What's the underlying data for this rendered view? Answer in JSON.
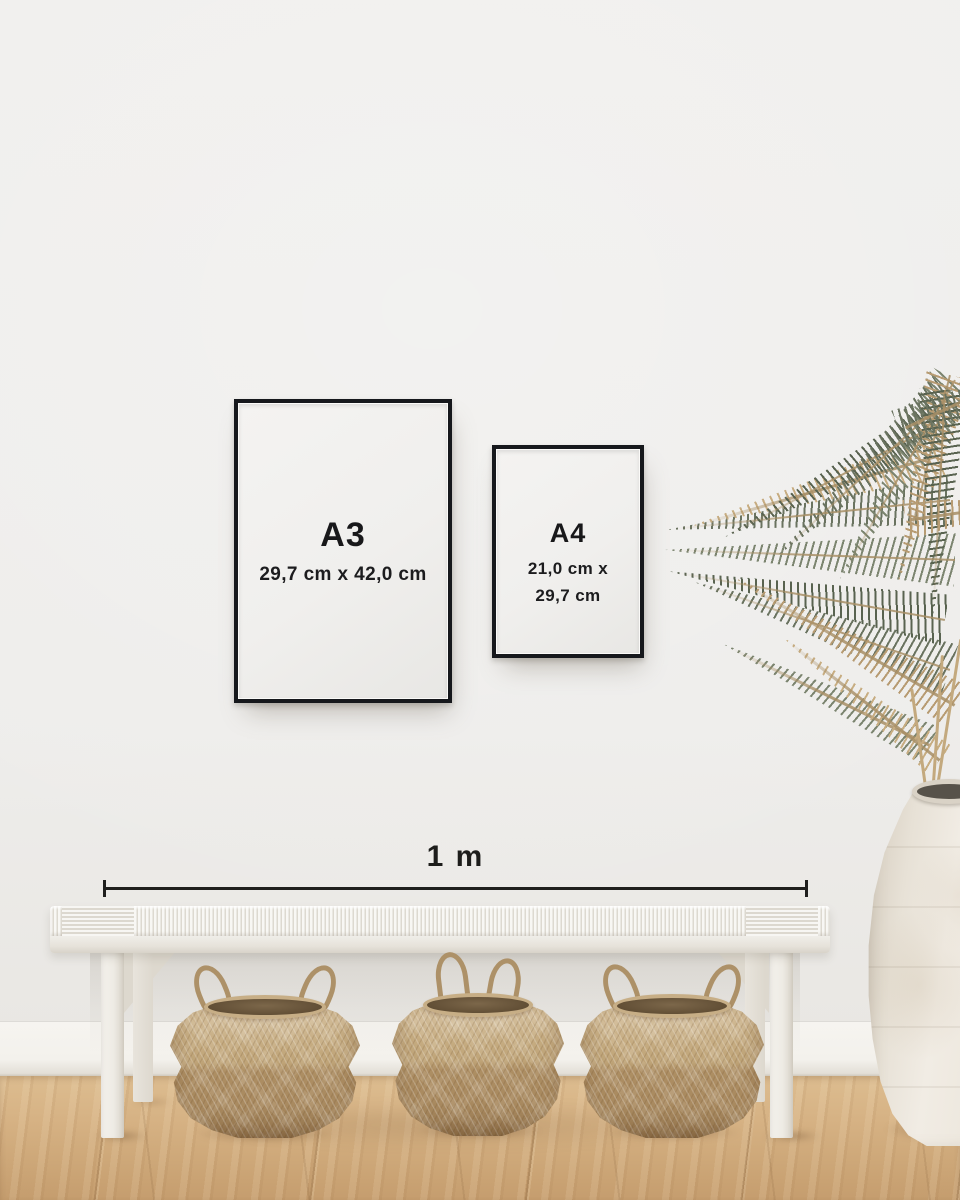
{
  "frames": {
    "a3": {
      "label": "A3",
      "dimensions": "29,7 cm x 42,0 cm"
    },
    "a4": {
      "label": "A4",
      "dimensions_line1": "21,0 cm x",
      "dimensions_line2": "29,7 cm"
    }
  },
  "scale_bar": {
    "label": "1 m"
  },
  "palette": {
    "wall": "#efeeec",
    "baseboard": "#f5f3ef",
    "floor_wood": "#cfa97c",
    "frame_border": "#16181c",
    "frame_paper": "#f2f1ef",
    "text": "#1b1b1b",
    "bench_white": "#f6f5f1",
    "basket_light": "#c9b188",
    "basket_dark": "#a8895f",
    "vase_ceramic": "#ebe5da",
    "plant_green": "#6a7360",
    "plant_tan": "#b79b72"
  }
}
